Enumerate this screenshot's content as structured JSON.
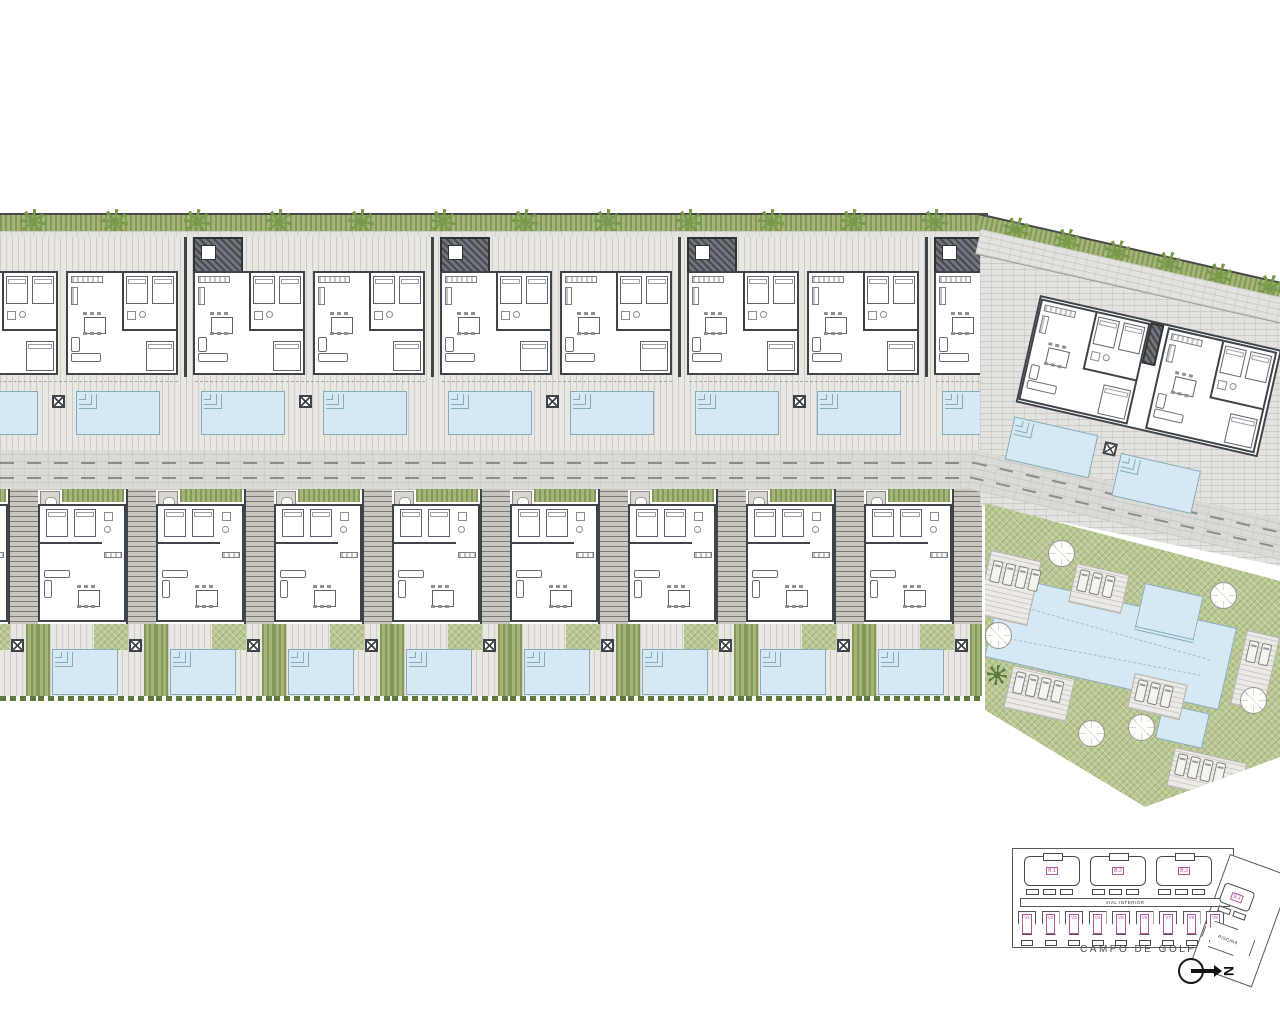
{
  "colors": {
    "wall": "#3f444a",
    "pool_fill": "#d4e9f3",
    "pool_border": "#86abbd",
    "lawn": "#b9c892",
    "hedge": "#a3b677",
    "tree": "#7a9a4b",
    "paving": "#e3e2de",
    "road": "#dbdad6",
    "keyplan_label": "#b0549b"
  },
  "site": {
    "top_tree_count": 12,
    "right_tree_count": 6,
    "apartment_block_count": 5,
    "pools_per_block": 2,
    "villa_count": 9,
    "community": {
      "parasol_count": 6,
      "sun_deck_count": 6,
      "small_pool_count": 2,
      "has_main_pool": true
    }
  },
  "keyplan": {
    "building_labels": [
      "B.1",
      "B.2",
      "B.3"
    ],
    "angled_building_label": "B.4",
    "villa_labels": [
      "V1",
      "V2",
      "V3",
      "V4",
      "V5",
      "V6",
      "V7",
      "V8",
      "V9"
    ],
    "road_label": "VIAL INTERIOR",
    "pool_building_label": "PISCINA",
    "golf_label": "CAMPO DE GOLF",
    "north_label": "N"
  }
}
